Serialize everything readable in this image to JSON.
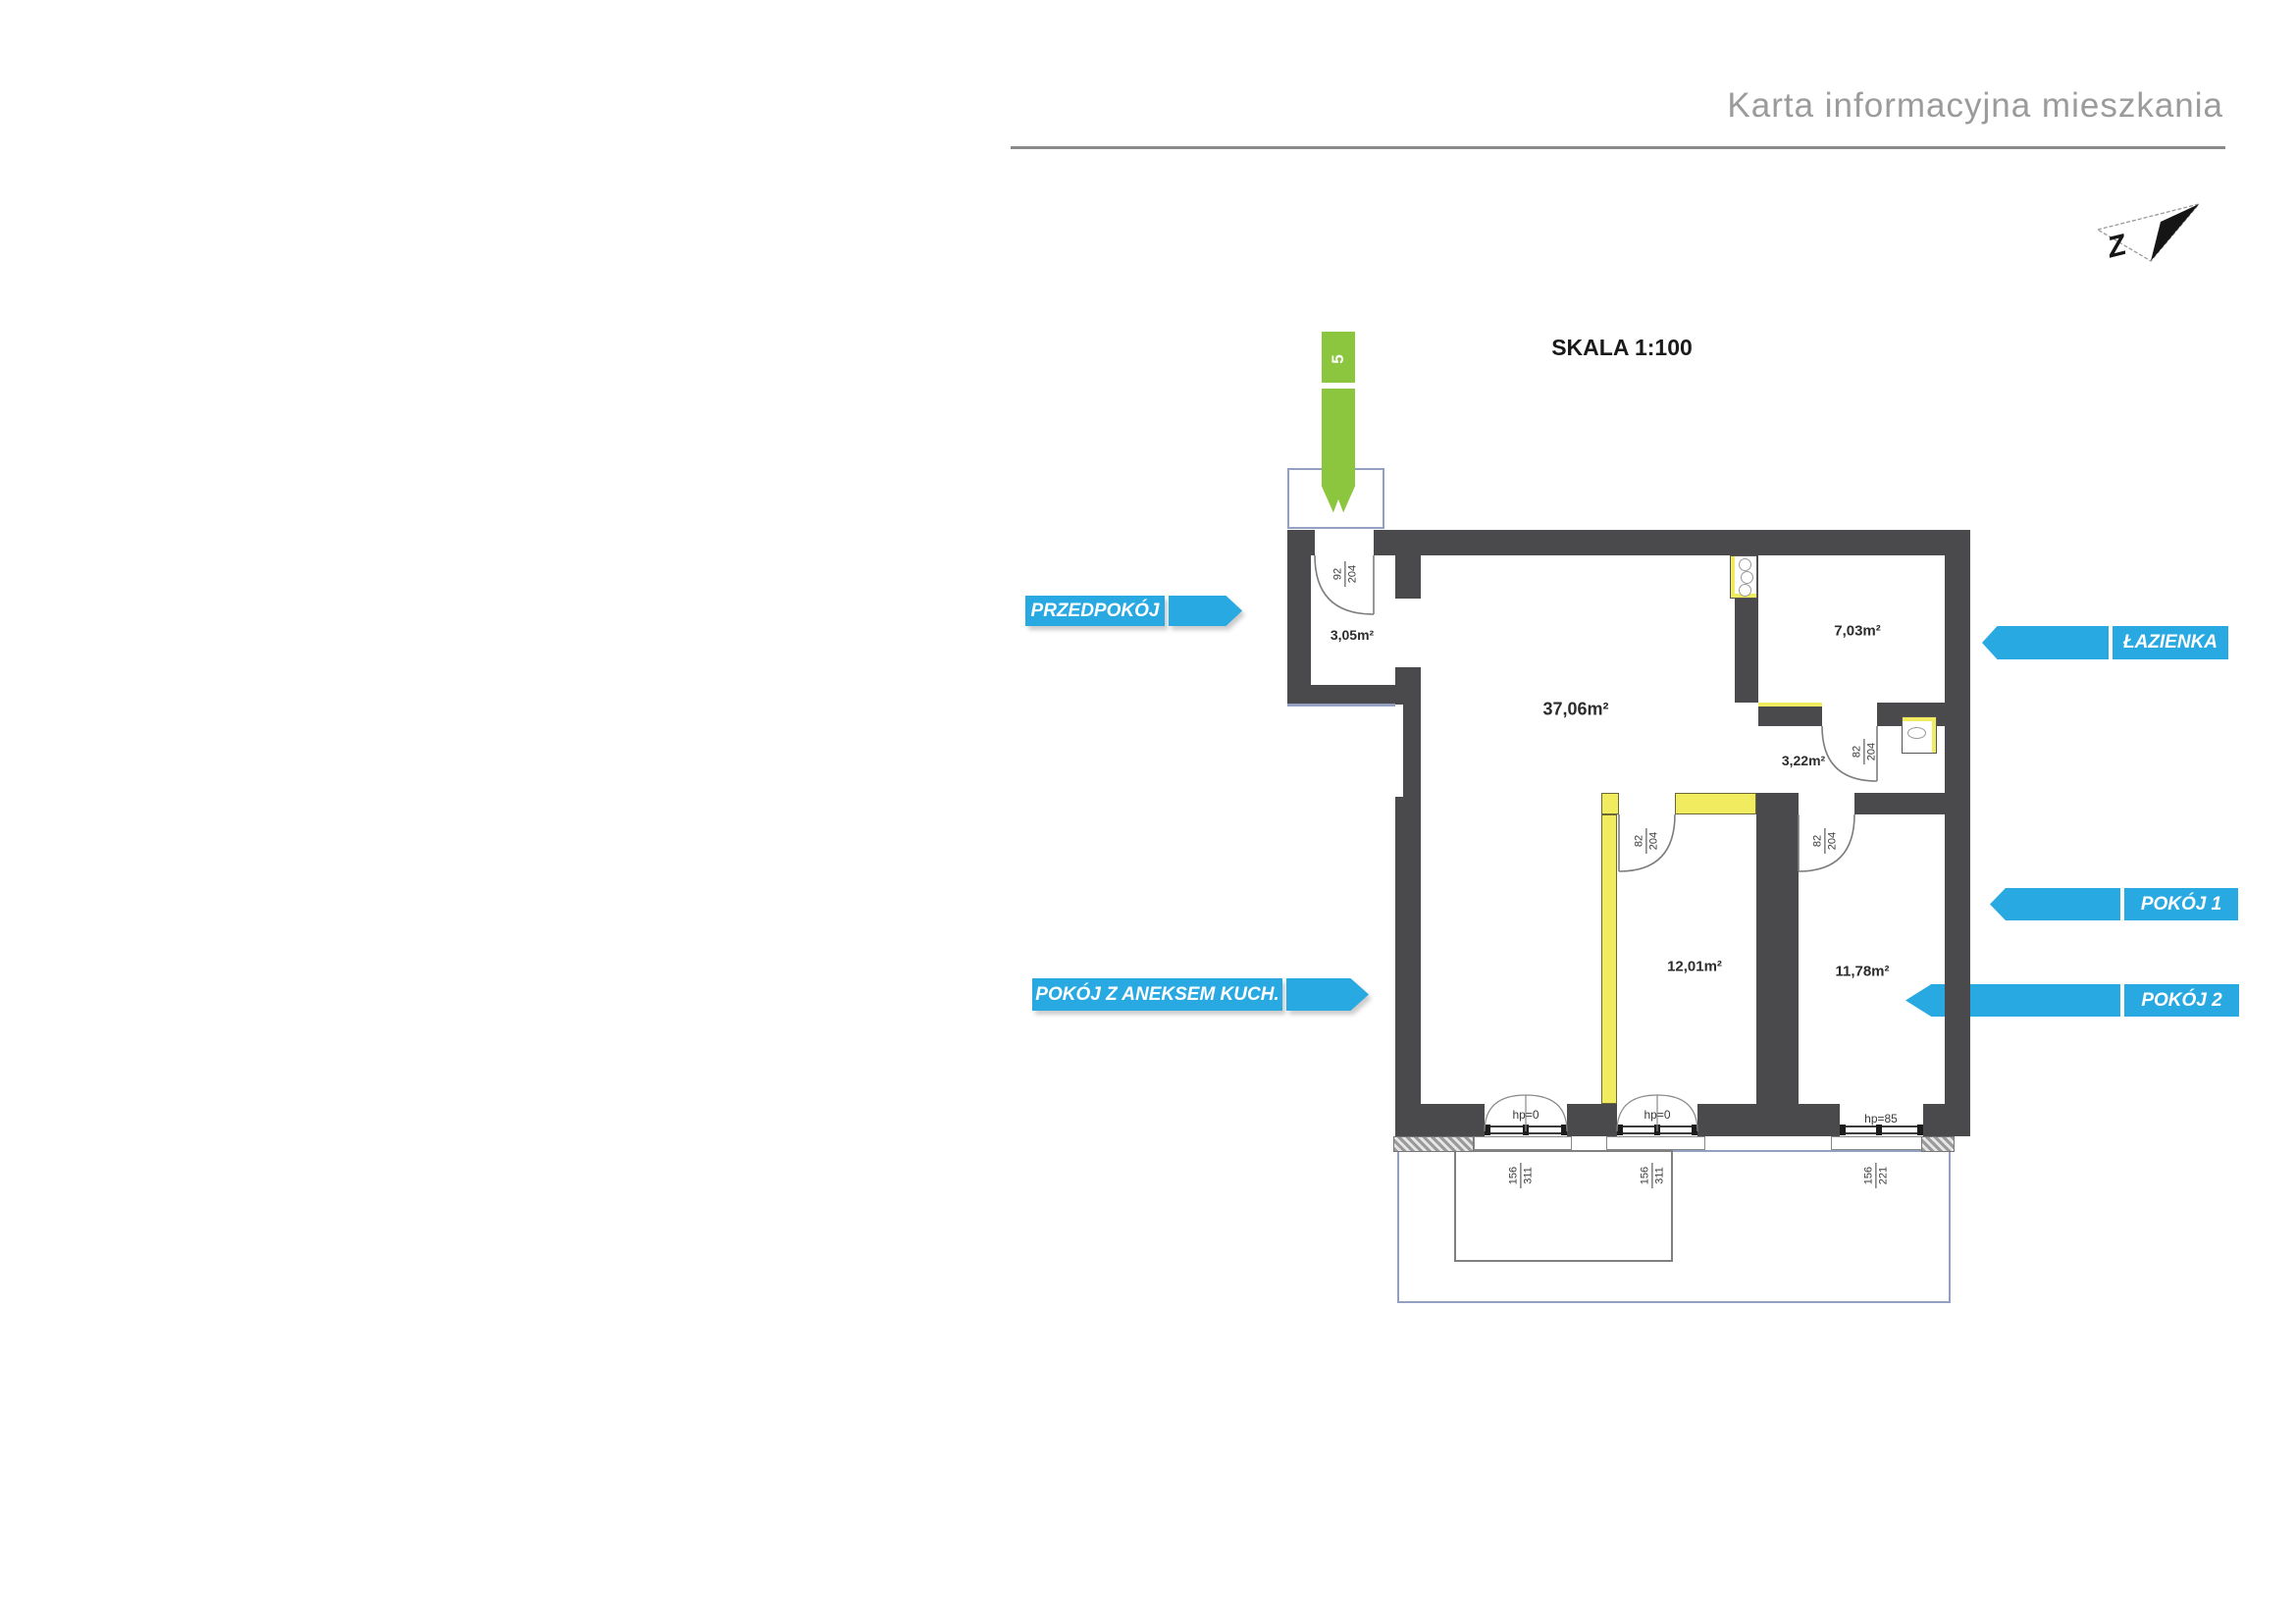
{
  "header": {
    "title": "Karta informacyjna mieszkania"
  },
  "plan": {
    "scale_label": "SKALA 1:100",
    "unit_number": "5",
    "rooms": [
      {
        "id": "przedpokoj",
        "area": "3,05m²"
      },
      {
        "id": "pokoj-z-aneksem",
        "area": "37,06m²"
      },
      {
        "id": "lazienka",
        "area": "7,03m²"
      },
      {
        "id": "korytarz",
        "area": "3,22m²"
      },
      {
        "id": "pokoj-1",
        "area": "12,01m²"
      },
      {
        "id": "pokoj-2",
        "area": "11,78m²"
      }
    ],
    "doors": [
      {
        "id": "entry-door",
        "width": "92",
        "height": "204"
      },
      {
        "id": "bathroom-door",
        "width": "82",
        "height": "204"
      },
      {
        "id": "room1-door",
        "width": "82",
        "height": "204"
      },
      {
        "id": "room2-door",
        "width": "82",
        "height": "204"
      }
    ],
    "windows": [
      {
        "id": "balcony-door-1",
        "label": "hp=0",
        "width": "156",
        "height": "311"
      },
      {
        "id": "balcony-door-2",
        "label": "hp=0",
        "width": "156",
        "height": "311"
      },
      {
        "id": "window-3",
        "label": "hp=85",
        "width": "156",
        "height": "221"
      }
    ]
  },
  "callouts": {
    "przedpokoj": "PRZEDPOKÓJ",
    "aneks": "POKÓJ Z ANEKSEM KUCH.",
    "lazienka": "ŁAZIENKA",
    "pokoj1": "POKÓJ 1",
    "pokoj2": "POKÓJ 2"
  },
  "colors": {
    "callout_blue": "#29A9E1",
    "entry_arrow_green": "#8CC63F",
    "wall_dark": "#4A4A4D",
    "wall_light_yellow": "#F1EC5F",
    "terrace_outline_blue": "#94A0C2",
    "title_gray": "#9B9B9B"
  }
}
